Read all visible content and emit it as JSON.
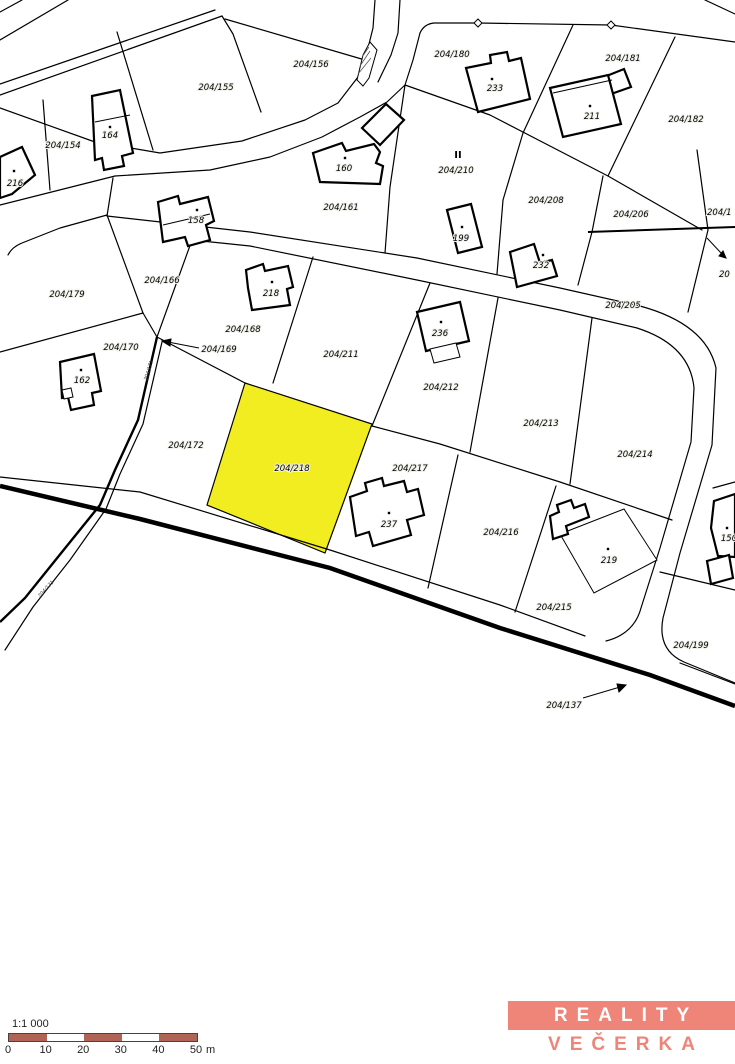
{
  "map": {
    "highlighted_parcel": {
      "label": "204/218",
      "fill": "#f2ed20"
    },
    "parcel_labels": [
      {
        "t": "204/156",
        "x": 311,
        "y": 67
      },
      {
        "t": "204/155",
        "x": 216,
        "y": 90
      },
      {
        "t": "204/154",
        "x": 63,
        "y": 148
      },
      {
        "t": "204/180",
        "x": 452,
        "y": 57
      },
      {
        "t": "204/181",
        "x": 623,
        "y": 61
      },
      {
        "t": "204/182",
        "x": 686,
        "y": 122
      },
      {
        "t": "204/210",
        "x": 456,
        "y": 173
      },
      {
        "t": "204/161",
        "x": 341,
        "y": 210
      },
      {
        "t": "204/208",
        "x": 546,
        "y": 203
      },
      {
        "t": "204/206",
        "x": 631,
        "y": 217
      },
      {
        "t": "204/205",
        "x": 623,
        "y": 308
      },
      {
        "t": "204/166",
        "x": 162,
        "y": 283
      },
      {
        "t": "204/179",
        "x": 67,
        "y": 297
      },
      {
        "t": "204/170",
        "x": 121,
        "y": 350
      },
      {
        "t": "204/169",
        "x": 219,
        "y": 352
      },
      {
        "t": "204/168",
        "x": 243,
        "y": 332
      },
      {
        "t": "204/211",
        "x": 341,
        "y": 357
      },
      {
        "t": "204/212",
        "x": 441,
        "y": 390
      },
      {
        "t": "204/213",
        "x": 541,
        "y": 426
      },
      {
        "t": "204/214",
        "x": 635,
        "y": 457
      },
      {
        "t": "204/172",
        "x": 186,
        "y": 448
      },
      {
        "t": "204/218",
        "x": 292,
        "y": 471
      },
      {
        "t": "204/217",
        "x": 410,
        "y": 471
      },
      {
        "t": "204/216",
        "x": 501,
        "y": 535
      },
      {
        "t": "204/215",
        "x": 554,
        "y": 610
      },
      {
        "t": "204/199",
        "x": 691,
        "y": 648
      },
      {
        "t": "204/137",
        "x": 564,
        "y": 708
      }
    ],
    "edge_labels": [
      {
        "t": "204/1",
        "x": 707,
        "y": 215
      },
      {
        "t": "20",
        "x": 719,
        "y": 277
      }
    ],
    "rotated_labels": [
      {
        "t": "204/171",
        "x": 150,
        "y": 371,
        "a": -73
      },
      {
        "t": "204/171",
        "x": 47,
        "y": 590,
        "a": -48
      }
    ],
    "symbol_labels": [
      {
        "t": "II",
        "x": 458,
        "y": 158
      }
    ],
    "building_labels": [
      {
        "t": "216",
        "x": 15,
        "y": 186,
        "dx": 14,
        "dy": 171
      },
      {
        "t": "164",
        "x": 110,
        "y": 138,
        "dx": 110,
        "dy": 127
      },
      {
        "t": "160",
        "x": 344,
        "y": 171,
        "dx": 345,
        "dy": 158
      },
      {
        "t": "233",
        "x": 495,
        "y": 91,
        "dx": 492,
        "dy": 79
      },
      {
        "t": "211",
        "x": 592,
        "y": 119,
        "dx": 590,
        "dy": 106
      },
      {
        "t": "158",
        "x": 196,
        "y": 223,
        "dx": 197,
        "dy": 210
      },
      {
        "t": "199",
        "x": 461,
        "y": 241,
        "dx": 462,
        "dy": 227
      },
      {
        "t": "232",
        "x": 541,
        "y": 268,
        "dx": 543,
        "dy": 255
      },
      {
        "t": "218",
        "x": 271,
        "y": 296,
        "dx": 272,
        "dy": 282
      },
      {
        "t": "236",
        "x": 440,
        "y": 336,
        "dx": 441,
        "dy": 322
      },
      {
        "t": "162",
        "x": 82,
        "y": 383,
        "dx": 81,
        "dy": 370
      },
      {
        "t": "237",
        "x": 389,
        "y": 527,
        "dx": 389,
        "dy": 513
      },
      {
        "t": "219",
        "x": 609,
        "y": 563,
        "dx": 608,
        "dy": 549
      },
      {
        "t": "150",
        "x": 729,
        "y": 541,
        "dx": 727,
        "dy": 528
      }
    ]
  },
  "scalebar": {
    "ratio": "1:1 000",
    "ticks": [
      "0",
      "10",
      "20",
      "30",
      "40",
      "50"
    ],
    "unit": "m",
    "bar_color": "#b06456",
    "segments": 5
  },
  "logo": {
    "line1": "REALITY",
    "line2": "VEČERKA",
    "accent": "#ef8578"
  }
}
